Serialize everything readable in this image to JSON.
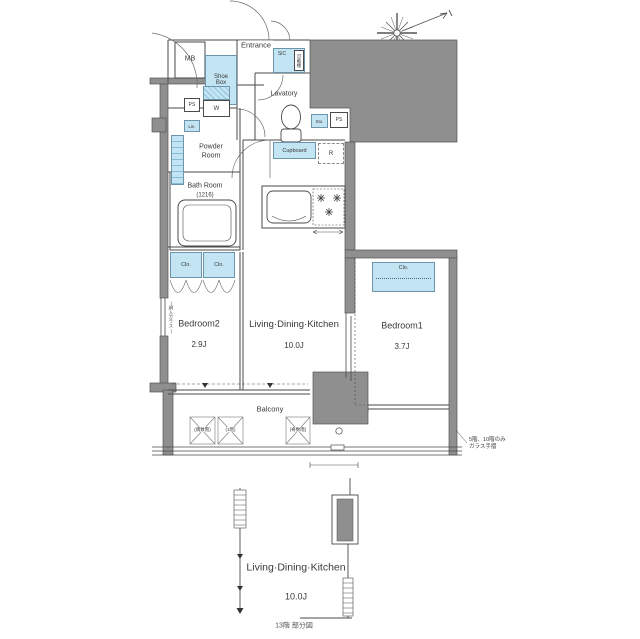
{
  "colors": {
    "wall": "#8f8f8f",
    "storage_fill": "#c3e4f3",
    "storage_border": "#6d95a9",
    "line": "#4a4a4a"
  },
  "plan": {
    "entrance": "Entrance",
    "mb": "MB",
    "shoe_box": "Shoe Box",
    "sic": "SIC",
    "sic_shelves": "可動棚",
    "lavatory": "Lavatory",
    "ps_left": "PS",
    "washer": "W",
    "linen": "Lin.",
    "powder_room": "Powder Room",
    "bath_room": "Bath Room",
    "bath_module": "(1216)",
    "storage": "Sto.",
    "ps_right": "PS",
    "cupboard": "Cupboard",
    "refrigerator": "R",
    "closet_left": "Clo.",
    "closet_mid": "Clo.",
    "closet_bedroom1": "Clo.",
    "bedroom2_name": "Bedroom2",
    "bedroom2_size": "2.9J",
    "ldk_name": "Living·Dining·Kitchen",
    "ldk_size": "10.0J",
    "bedroom1_name": "Bedroom1",
    "bedroom1_size": "3.7J",
    "balcony": "Balcony",
    "window_note": "(網入ガラス)"
  },
  "balcony_annotations": {
    "even_floors": "(偶数階)",
    "first_floor": "(1階)",
    "odd_floors": "(奇数階)",
    "rail_note_line1": "5階、10階のみ",
    "rail_note_line2": "ガラス手摺"
  },
  "partial_plan": {
    "ldk_name": "Living·Dining·Kitchen",
    "ldk_size": "10.0J",
    "caption": "13階 部分図"
  }
}
